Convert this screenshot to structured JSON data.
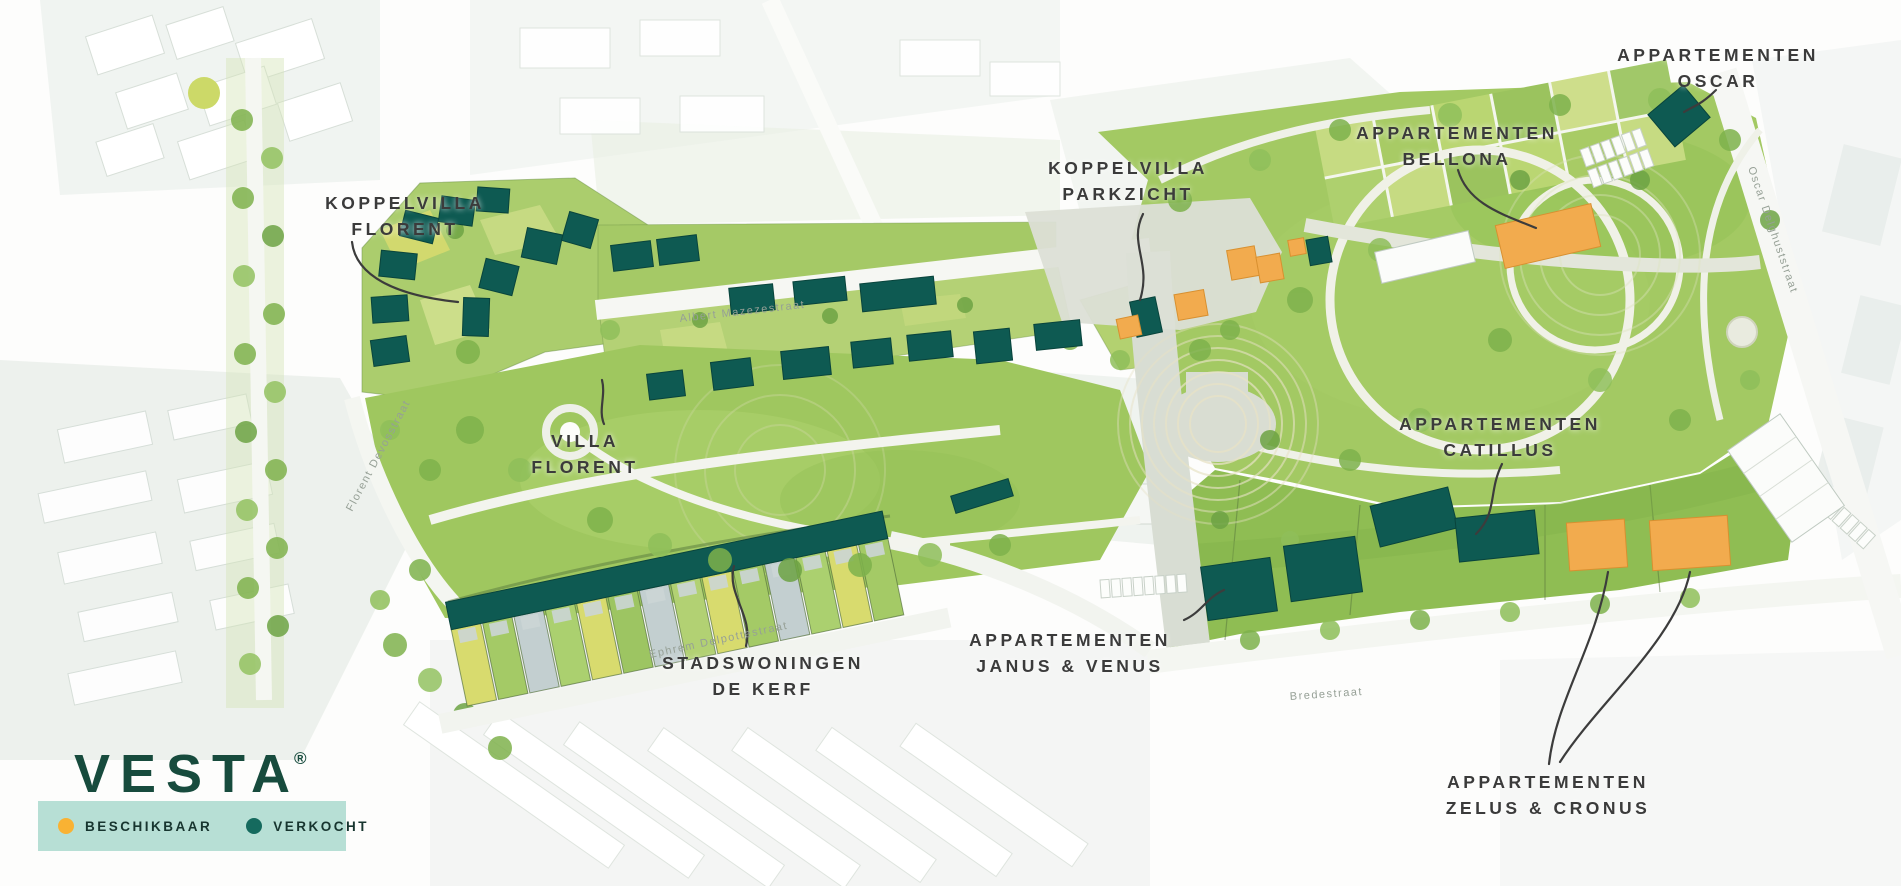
{
  "brand": {
    "name": "VESTA",
    "registered": "®"
  },
  "legend": {
    "available": {
      "label": "BESCHIKBAAR",
      "color": "#F9B233"
    },
    "sold": {
      "label": "VERKOCHT",
      "color": "#156A5E"
    }
  },
  "colors": {
    "building_sold": "#0E5A52",
    "building_available": "#F2AB4E",
    "legend_background": "#B7DFD5",
    "logo_green": "#174B3D",
    "label_text": "#3B3B3B"
  },
  "projects": [
    {
      "id": "koppelvilla-florent",
      "lines": [
        "KOPPELVILLA",
        "FLORENT"
      ],
      "status": "verkocht"
    },
    {
      "id": "villa-florent",
      "lines": [
        "VILLA",
        "FLORENT"
      ],
      "status": "verkocht"
    },
    {
      "id": "koppelvilla-parkzicht",
      "lines": [
        "KOPPELVILLA",
        "PARKZICHT"
      ],
      "status": "gemengd"
    },
    {
      "id": "appartementen-bellona",
      "lines": [
        "APPARTEMENTEN",
        "BELLONA"
      ],
      "status": "beschikbaar"
    },
    {
      "id": "appartementen-oscar",
      "lines": [
        "APPARTEMENTEN",
        "OSCAR"
      ],
      "status": "verkocht"
    },
    {
      "id": "appartementen-catillus",
      "lines": [
        "APPARTEMENTEN",
        "CATILLUS"
      ],
      "status": "verkocht"
    },
    {
      "id": "stadswoningen-de-kerf",
      "lines": [
        "STADSWONINGEN",
        "DE KERF"
      ],
      "status": "verkocht"
    },
    {
      "id": "appartementen-janus-venus",
      "lines": [
        "APPARTEMENTEN",
        "JANUS & VENUS"
      ],
      "status": "verkocht"
    },
    {
      "id": "appartementen-zelus-cronus",
      "lines": [
        "APPARTEMENTEN",
        "ZELUS & CRONUS"
      ],
      "status": "beschikbaar"
    }
  ],
  "streets": [
    "Albert Mazezestraat",
    "Florent Devosstraat",
    "Ephrem Delpottestraat",
    "Bredestraat",
    "Oscar Delghuststraat"
  ]
}
